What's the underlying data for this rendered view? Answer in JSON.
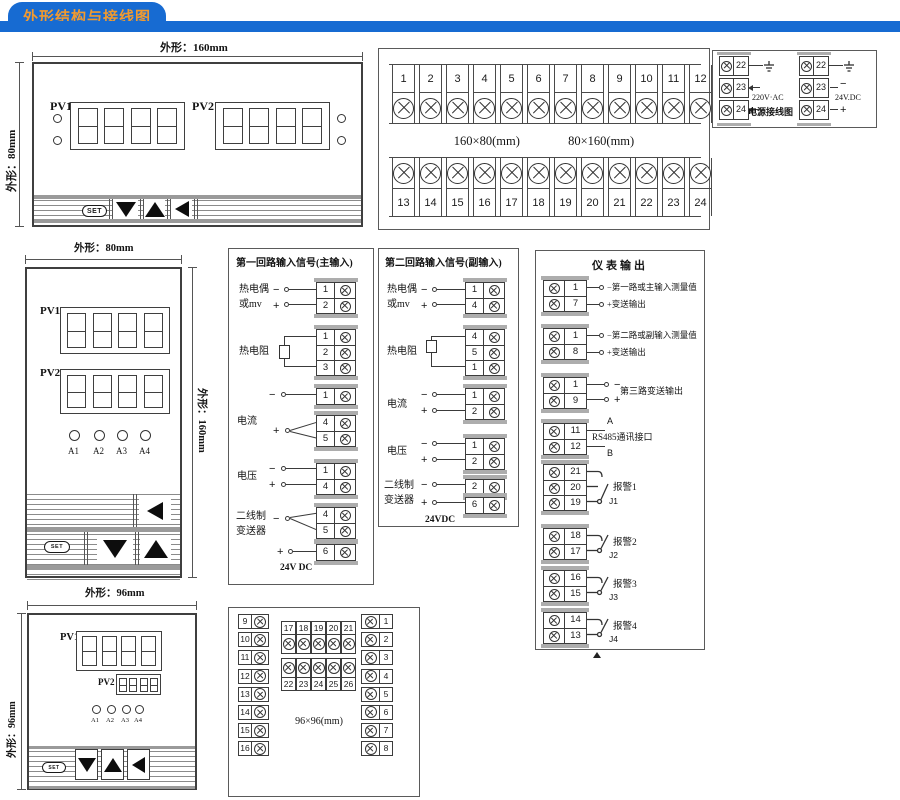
{
  "header": {
    "title": "外形结构与接线图"
  },
  "colors": {
    "header_blue": "#176bd2",
    "header_orange": "#f09a30",
    "line": "#3a3a3a",
    "cap_gray": "#adadad"
  },
  "panel_a": {
    "dim_top": "外形：160mm",
    "dim_left": "外形：80mm",
    "pv1": "PV1",
    "pv2": "PV2",
    "set": "SET"
  },
  "main_terminals": {
    "top": [
      "1",
      "2",
      "3",
      "4",
      "5",
      "6",
      "7",
      "8",
      "9",
      "10",
      "11",
      "12"
    ],
    "bottom": [
      "13",
      "14",
      "15",
      "16",
      "17",
      "18",
      "19",
      "20",
      "21",
      "22",
      "23",
      "24"
    ],
    "size_left": "160×80(mm)",
    "size_right": "80×160(mm)"
  },
  "power": {
    "ac_terms": [
      "22",
      "23",
      "24"
    ],
    "dc_terms": [
      "22",
      "23",
      "24"
    ],
    "ac_label": "220V·AC",
    "dc_label": "24V.DC",
    "title": "电源接线图",
    "minus": "−",
    "plus": "+"
  },
  "panel_b": {
    "dim_top": "外形：80mm",
    "dim_right": "外形：160mm",
    "pv1": "PV1",
    "pv2": "PV2",
    "set": "SET",
    "alarms": [
      "A1",
      "A2",
      "A3",
      "A4"
    ]
  },
  "loop1": {
    "title": "第一回路输入信号(主输入)",
    "tc_label1": "热电偶",
    "tc_label2": "或mv",
    "rtd_label": "热电阻",
    "current_label": "电流",
    "voltage_label": "电压",
    "tx_label1": "二线制",
    "tx_label2": "变送器",
    "psu_label": "24V DC",
    "minus": "−",
    "plus": "+",
    "tc_terms": [
      "1",
      "2"
    ],
    "rtd_terms": [
      "1",
      "2",
      "3"
    ],
    "cur_m_terms": [
      "1"
    ],
    "cur_p_terms": [
      "4",
      "5"
    ],
    "volt_terms": [
      "1",
      "4"
    ],
    "tx_m_terms": [
      "4",
      "5"
    ],
    "tx_p_terms": [
      "6"
    ]
  },
  "loop2": {
    "title": "第二回路输入信号(副输入)",
    "tc_label1": "热电偶",
    "tc_label2": "或mv",
    "rtd_label": "热电阻",
    "current_label": "电流",
    "voltage_label": "电压",
    "tx_label1": "二线制",
    "tx_label2": "变送器",
    "psu_label": "24VDC",
    "minus": "−",
    "plus": "+",
    "tc_terms": [
      "1",
      "4"
    ],
    "rtd_terms": [
      "4",
      "5",
      "1"
    ],
    "cur_terms": [
      "1",
      "2"
    ],
    "volt_terms": [
      "1",
      "2"
    ],
    "tx_m_terms": [
      "2"
    ],
    "tx_p_terms": [
      "6"
    ]
  },
  "output": {
    "title": "仪表输出",
    "g1_terms": [
      "1",
      "7"
    ],
    "g1_line1": "−第一路或主输入测量值",
    "g1_line2": "+变送输出",
    "g2_terms": [
      "1",
      "8"
    ],
    "g2_line1": "−第二路或副输入测量值",
    "g2_line2": "+变送输出",
    "g3_terms": [
      "1",
      "9"
    ],
    "g3_minus": "−",
    "g3_plus": "+",
    "g3_label": "第三路变送输出",
    "g4_terms": [
      "11",
      "12"
    ],
    "g4_a": "A",
    "g4_b": "B",
    "g4_label": "RS485通讯接口",
    "alarm1_terms": [
      "21",
      "20",
      "19"
    ],
    "alarm1_label": "报警1",
    "alarm1_j": "J1",
    "alarm2_terms": [
      "18",
      "17"
    ],
    "alarm2_label": "报警2",
    "alarm2_j": "J2",
    "alarm3_terms": [
      "16",
      "15"
    ],
    "alarm3_label": "报警3",
    "alarm3_j": "J3",
    "alarm4_terms": [
      "14",
      "13"
    ],
    "alarm4_label": "报警4",
    "alarm4_j": "J4"
  },
  "panel_c": {
    "dim_top": "外形：96mm",
    "dim_left": "外形：96mm",
    "pv1": "PV1",
    "pv2": "PV2",
    "set": "SET",
    "alarms": [
      "A1",
      "A2",
      "A3",
      "A4"
    ]
  },
  "term96": {
    "left": [
      "9",
      "10",
      "11",
      "12",
      "13",
      "14",
      "15",
      "16"
    ],
    "mid_top": [
      "17",
      "18",
      "19",
      "20",
      "21"
    ],
    "mid_bottom": [
      "22",
      "23",
      "24",
      "25",
      "26"
    ],
    "right": [
      "1",
      "2",
      "3",
      "4",
      "5",
      "6",
      "7",
      "8"
    ],
    "size_label": "96×96(mm)"
  }
}
